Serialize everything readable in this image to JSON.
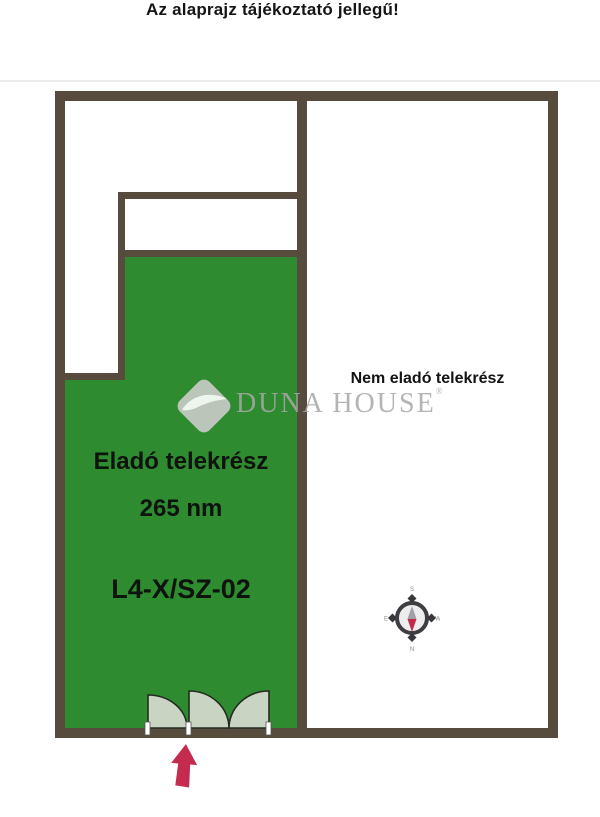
{
  "disclaimer": "Az alaprajz tájékoztató jellegű!",
  "plan": {
    "sale_area": {
      "label": "Eladó telekrész",
      "size": "265 nm",
      "code": "L4-X/SZ-02"
    },
    "non_sale_area": {
      "label": "Nem eladó telekrész"
    },
    "logo": {
      "brand": "Duna House",
      "text": "DUNA HOUSE",
      "registered": "®"
    },
    "compass": {
      "top": "S",
      "right": "W",
      "bottom": "N",
      "left": "E"
    },
    "colors": {
      "wall": "#564b3c",
      "sale_fill": "#2f8b30",
      "gate_fill": "#c9d5c2",
      "gate_stroke": "#252b22",
      "arrow": "#c52b4f",
      "logo_gray": "#a8a8a8"
    }
  }
}
